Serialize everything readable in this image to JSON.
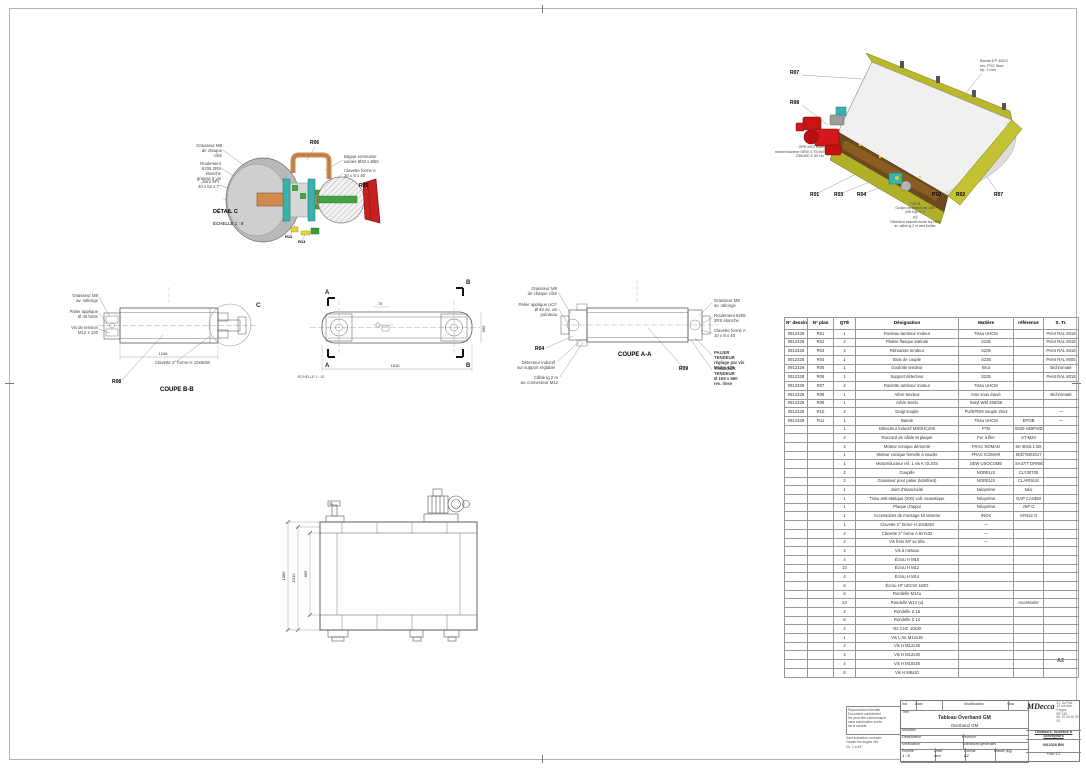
{
  "sheet": {
    "format": "A2",
    "drawing_number": "0912328 R00"
  },
  "detail_view": {
    "caption": "DÉTAIL C",
    "scale": "ÉCHELLE 1 : 8",
    "label_r06": "R06",
    "label_r05": "R05",
    "label_r12": "R12",
    "label_r13": "R13",
    "callout_left_1": "Graisseur M8\nde chaque côté",
    "callout_left_2": "Roulement 6206 2RS\nétanche graissé à vie",
    "callout_left_3": "Joint SPI\n40 x 62 x 7",
    "callout_right_1": "Bague entretoise\nusinée Ø40 x Ø50",
    "callout_right_2": "Clavette forme A\n10 x 8 x 40"
  },
  "iso_view": {
    "label_r07_top": "R07",
    "label_r08": "R08",
    "note_belt": "Bande EP 400/3\nrev. PVC lisse\nép. 2 mm",
    "note_motor": "GPE MOTEUR\nmotoréducteur SEW 0,75 kW\n230/400 V  50 Hz",
    "bottom_labels": [
      "R01",
      "R03",
      "R04",
      "P10",
      "R02",
      "R07"
    ],
    "note_1": "TGE B\nGoujon de fixation av LBA\n(M8 x 30 x 7)",
    "note_2": "P9\nDétecteur inductif monté sur R04\nav. câble lg 2 m vers boîtier"
  },
  "coupe_bb": {
    "caption": "COUPE B-B",
    "detail_letter": "C",
    "label_r08": "R08",
    "note_key": "Clavette 2° forme H 10x8x50",
    "callout_1": "Graisseur M8\nav. rallonge",
    "callout_2": "Palier applique\nØ 40 fonte",
    "callout_3": "Vis de tension\nM12 x 120",
    "dim_length": "1246"
  },
  "plan_view": {
    "marker_a": "A",
    "marker_b": "B",
    "scale_note": "ÉCHELLE 1 : 10",
    "dim_width": "1510",
    "dim_height": "560",
    "dim_small": "75"
  },
  "coupe_aa": {
    "caption": "COUPE A-A",
    "label_r04": "R04",
    "label_r09": "R09",
    "callout_left_1": "Graisseur M8\nde chaque côté",
    "callout_left_2": "Palier applique UCF\nØ 40 av. vis pointeau",
    "callout_bottom_1": "Détecteur inductif\nsur support réglable",
    "callout_bottom_2": "Câble lg 2 m\nav. connecteur M12",
    "callout_right_1": "Graisseur M8\nav. rallonge",
    "callout_right_2": "Roulement 6208\n2RS étanche",
    "callout_right_3": "Clavette forme A\n10 x 8 x 40",
    "callout_right_4": "PALIER TENDEUR\nréglage par vis\nM12 x 120",
    "callout_right_5": "TAMBOUR TENDEUR\nØ 159 x 560\nrev. lisse"
  },
  "front_view": {
    "dim_1": "1085",
    "dim_2": "1010",
    "dim_3": "895"
  },
  "bom": {
    "headers": [
      "N° dessin",
      "N° plan",
      "QTÉ",
      "Désignation",
      "Matière",
      "référence",
      "S. Tr."
    ],
    "rows": [
      [
        "0912328",
        "R01",
        "1",
        "Rouleau tambour moteur",
        "Tissu UHCM",
        "",
        "Peint RAL 6018"
      ],
      [
        "0912328",
        "R02",
        "2",
        "Platine flasque latérale",
        "S235",
        "",
        "Peint RAL 6018"
      ],
      [
        "0912328",
        "R03",
        "2",
        "Réhausse tendeur",
        "S235",
        "",
        "Peint RAL 6018"
      ],
      [
        "0912328",
        "R04",
        "1",
        "Bras de couple",
        "S235",
        "",
        "Peint RAL 9005"
      ],
      [
        "0912328",
        "R05",
        "1",
        "Goulotte tendeur",
        "Brut",
        "",
        "Bichromaté"
      ],
      [
        "0912328",
        "R06",
        "1",
        "Support détecteur",
        "S235",
        "",
        "Peint RAL 6018"
      ],
      [
        "0912328",
        "R07",
        "2",
        "Raclette tambour moteur",
        "Tissu UHCM",
        "",
        ""
      ],
      [
        "0912328",
        "R08",
        "1",
        "Arbre tendeur",
        "Inox sous étuvé",
        "",
        "Bichromaté"
      ],
      [
        "0912328",
        "R09",
        "1",
        "Arbre tendu",
        "Butyl WM 260/38",
        "",
        ""
      ],
      [
        "0912328",
        "R10",
        "2",
        "Doigt souple",
        "PU/EPDM souple 20x3",
        "",
        "—"
      ],
      [
        "0912328",
        "R11",
        "1",
        "Bande",
        "Tissu UHCM",
        "EP/3B",
        "—"
      ],
      [
        "",
        "",
        "1",
        "Détecteur inductif M30/HC200",
        "PTB",
        "IM30-15BPS/ZC",
        ""
      ],
      [
        "",
        "",
        "2",
        "Raccord de câble M plaqué",
        "Fer à filer",
        "ST-M20",
        ""
      ],
      [
        "",
        "",
        "2",
        "Moteur conique démonté",
        "FRAC NOMAD",
        "SK 9016.1 BX",
        ""
      ],
      [
        "",
        "",
        "1",
        "Moteur conique femelle à souder",
        "FRAC ICEMAR",
        "SKD750/2017",
        ""
      ],
      [
        "",
        "",
        "1",
        "Motoréducteur réf. 1 vis K OLIOS",
        "SEW USOCOME",
        "SA47/T DRN80",
        ""
      ],
      [
        "",
        "",
        "2",
        "Goupille",
        "NORELIS",
        "CLY30705",
        ""
      ],
      [
        "",
        "",
        "2",
        "Graisseur pour palier (lubrifiant)",
        "NORELIS",
        "CLAIRSUS",
        ""
      ],
      [
        "",
        "",
        "1",
        "Joint d'étanchéité",
        "Néoprène",
        "Néo",
        ""
      ],
      [
        "",
        "",
        "1",
        "Tissu anti-statique (200) volt. acoustique",
        "Néoprène",
        "GAP CASEM",
        ""
      ],
      [
        "",
        "",
        "1",
        "Plaque d'appui",
        "Néoprène",
        "JSP G",
        ""
      ],
      [
        "",
        "",
        "1",
        "Accessoires de montage kit visserie",
        "INOX",
        "AFN12 G",
        ""
      ],
      [
        "",
        "",
        "1",
        "Clavette 2° forme H 10x8x50",
        "—",
        "",
        ""
      ],
      [
        "",
        "",
        "2",
        "Clavette 2° forme A 8x7x32",
        "—",
        "",
        ""
      ],
      [
        "",
        "",
        "2",
        "Vis frein M7 av tête",
        "—",
        "",
        ""
      ],
      [
        "",
        "",
        "2",
        "Vis à métaux",
        "",
        "",
        ""
      ],
      [
        "",
        "",
        "4",
        "Écrou H M10",
        "",
        "",
        ""
      ],
      [
        "",
        "",
        "10",
        "Écrou H M12",
        "",
        "",
        ""
      ],
      [
        "",
        "",
        "4",
        "Écrou H M14",
        "",
        "",
        ""
      ],
      [
        "",
        "",
        "6",
        "Écrou HT UECW 160G",
        "",
        "",
        ""
      ],
      [
        "",
        "",
        "6",
        "Rondelle M14u",
        "",
        "",
        ""
      ],
      [
        "",
        "",
        "24",
        "Rondelle W14 (u)",
        "",
        "Accessoire",
        ""
      ],
      [
        "",
        "",
        "2",
        "Rondelle Z 16",
        "",
        "",
        ""
      ],
      [
        "",
        "",
        "6",
        "Rondelle Z 14",
        "",
        "",
        ""
      ],
      [
        "",
        "",
        "2",
        "Vis CHC 10x30",
        "",
        "",
        ""
      ],
      [
        "",
        "",
        "1",
        "Vis L NL M12x35",
        "",
        "",
        ""
      ],
      [
        "",
        "",
        "2",
        "Vis H M12x35",
        "",
        "",
        ""
      ],
      [
        "",
        "",
        "4",
        "Vis H M12x30",
        "",
        "",
        ""
      ],
      [
        "",
        "",
        "4",
        "Vis H M10x25",
        "",
        "",
        ""
      ],
      [
        "",
        "",
        "6",
        "Vis H M8x20",
        "",
        "",
        ""
      ]
    ]
  },
  "title_block": {
    "ind_label": "Ind",
    "date_label": "Date",
    "modification_label": "Modification",
    "visa_label": "Visa",
    "title_label": "Titre :",
    "title_line1": "Tableau Overband GM",
    "title_line2": "Overband GM",
    "row_modified": "Modifiée",
    "row_drawn": "Dessinateur",
    "row_revision": "Révision",
    "row_checked": "Vérification",
    "row_tolerances": "Tolérances générales",
    "scale_label": "Échelle",
    "scale_value": "1 : 8",
    "unit_label": "Unité",
    "unit_value": "mm",
    "format_label": "Format",
    "format_value": "A2",
    "mass_label": "Masse (kg)",
    "logo_text": "MDecca",
    "logo_address": "Z.I. du Port\n12 rue des Forges\nBP 128\ntél. 02 40 00 00 00",
    "footer_line": "Tambours, rouleaux & convoyeurs",
    "drawing_number": "0912328 R00",
    "folio": "Folio 1/1"
  },
  "notes": {
    "box_lines": "Reproduction interdite\nDocument confidentiel\nNe peut être communiqué\nsans autorisation écrite\nde la société",
    "below_lines": "Sauf indication contraire :\nCasser les angles vifs\nCh. 1 à 45°"
  },
  "colors": {
    "frame_yellow": "#b8b82a",
    "motor_red": "#cc1515",
    "bearing_teal": "#38b2aa",
    "shaft_copper": "#cf8a50",
    "key_green": "#46a046"
  }
}
